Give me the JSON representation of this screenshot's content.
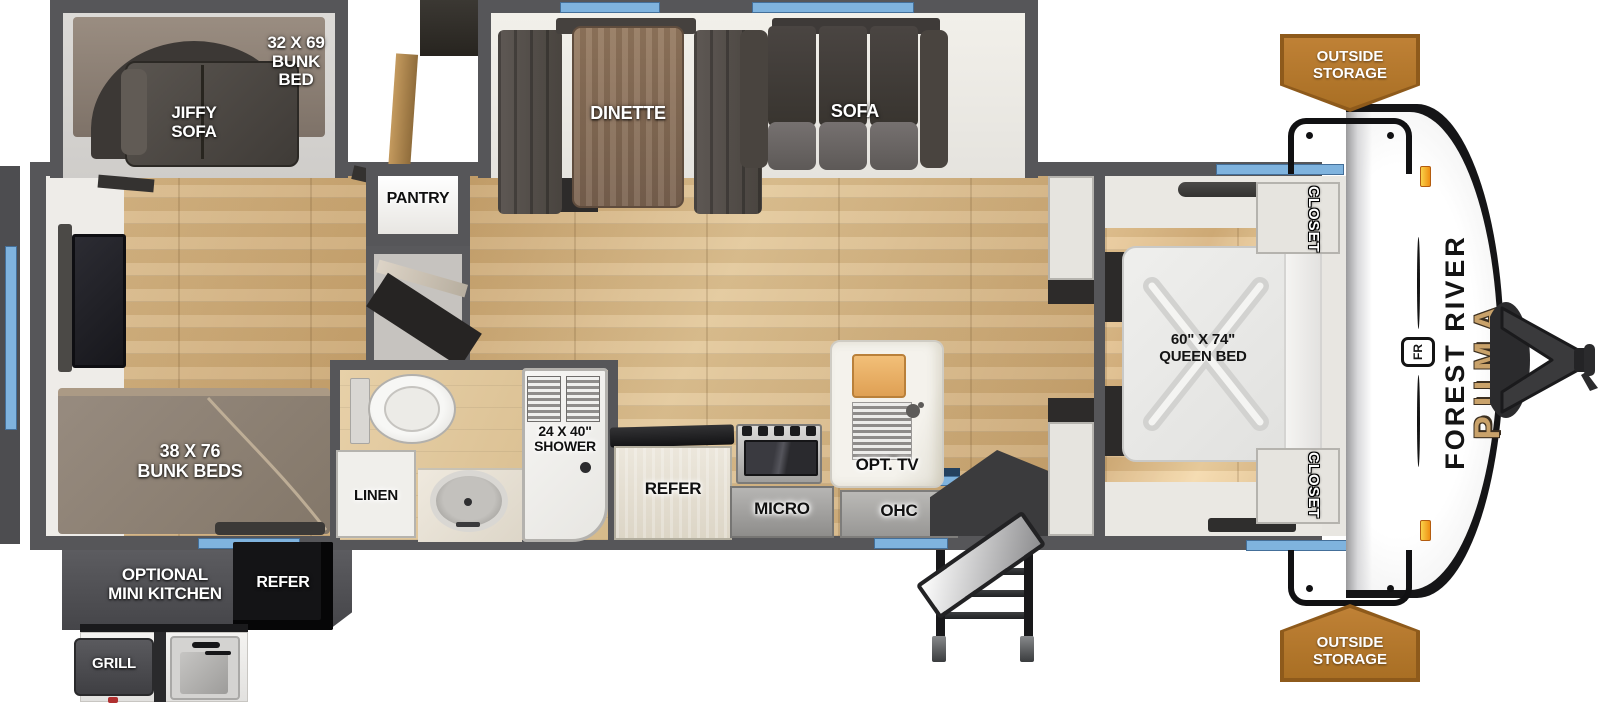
{
  "title": "Forest River Puma travel trailer floor plan",
  "labels": {
    "rear_bunk": "32 X 69\nBUNK\nBED",
    "jiffy_sofa": "JIFFY\nSOFA",
    "pantry": "PANTRY",
    "dinette": "DINETTE",
    "sofa": "SOFA",
    "bunk_beds": "38 X 76\nBUNK BEDS",
    "optional_mini_kitchen": "OPTIONAL\nMINI KITCHEN",
    "mini_kitchen_refer": "REFER",
    "grill": "GRILL",
    "linen": "LINEN",
    "shower": "24 X 40\"\nSHOWER",
    "refer": "REFER",
    "micro": "MICRO",
    "ohc": "OHC",
    "opt_tv": "OPT. TV",
    "queen_bed": "60\" X 74\"\nQUEEN BED",
    "closet_top": "CLOSET",
    "closet_bottom": "CLOSET",
    "outside_storage_top": "OUTSIDE\nSTORAGE",
    "outside_storage_bottom": "OUTSIDE\nSTORAGE",
    "brand": "FOREST RIVER",
    "brand_badge": "FR",
    "model": "PUMA"
  },
  "colors": {
    "wall_gray": "#565659",
    "floor_tan": "#d0ac79",
    "window_blue": "#7fb3de",
    "storage_banner_orange": "#a96f24",
    "puma_gold": "#c9a26a",
    "cap_white": "#ffffff",
    "furniture_dark": "#49443f"
  }
}
